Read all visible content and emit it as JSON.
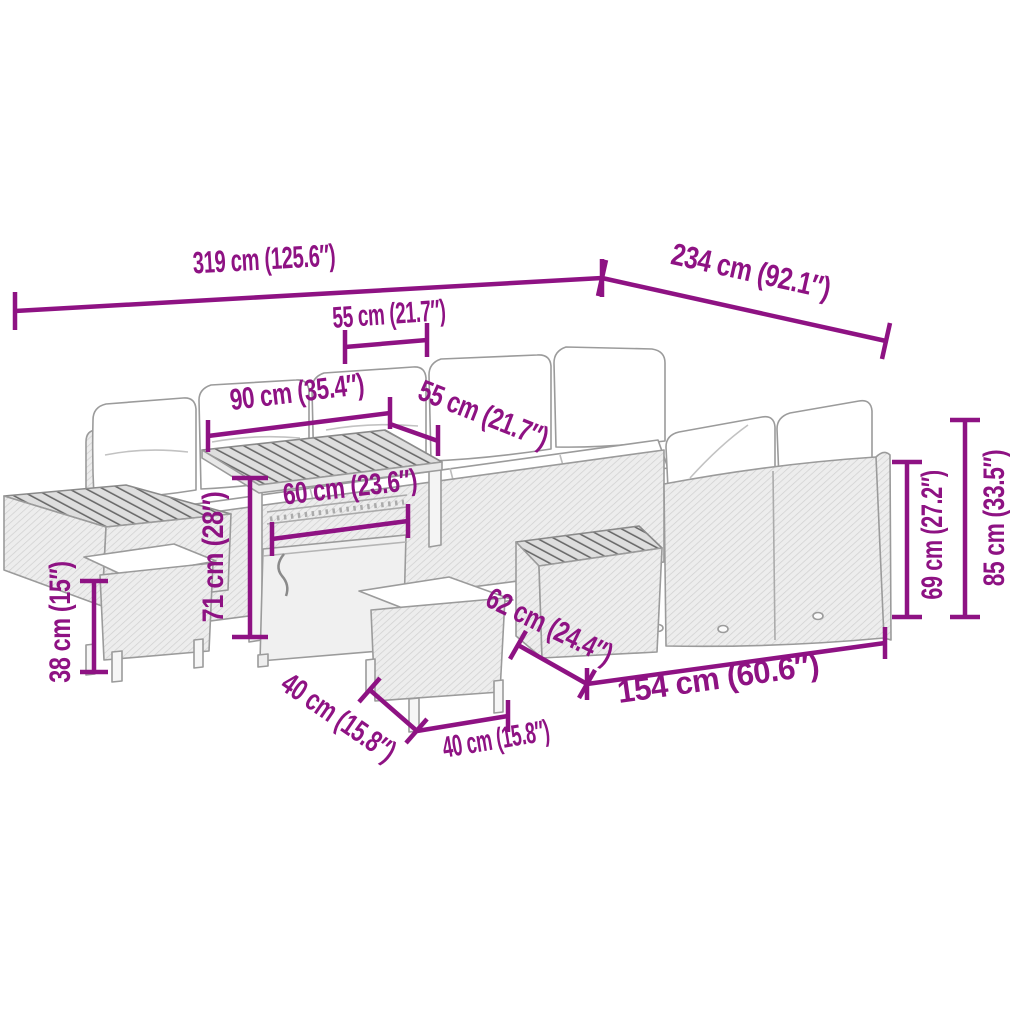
{
  "diagram": {
    "type": "product-dimension-diagram",
    "subject": "poly rattan garden corner sofa set with storage table, side tables and two cushion stools (line-art sketch)",
    "unit_format": "cm (inches)",
    "colors": {
      "accent": "#8E1283",
      "sketch": "#9b9b9b"
    },
    "dimensions": [
      {
        "id": "total-width",
        "label": "319 cm (125.6″)",
        "value_cm": 319,
        "value_in": 125.6
      },
      {
        "id": "total-depth",
        "label": "234 cm (92.1″)",
        "value_cm": 234,
        "value_in": 92.1
      },
      {
        "id": "seat-section-width",
        "label": "55 cm (21.7″)",
        "value_cm": 55,
        "value_in": 21.7
      },
      {
        "id": "table-length",
        "label": "90 cm (35.4″)",
        "value_cm": 90,
        "value_in": 35.4
      },
      {
        "id": "seat-depth",
        "label": "55 cm (21.7″)",
        "value_cm": 55,
        "value_in": 21.7
      },
      {
        "id": "table-width",
        "label": "60 cm (23.6″)",
        "value_cm": 60,
        "value_in": 23.6
      },
      {
        "id": "table-height",
        "label": "71 cm (28″)",
        "value_cm": 71,
        "value_in": 28
      },
      {
        "id": "stool-height",
        "label": "38 cm (15″)",
        "value_cm": 38,
        "value_in": 15
      },
      {
        "id": "stool-depth",
        "label": "40 cm (15.8″)",
        "value_cm": 40,
        "value_in": 15.8
      },
      {
        "id": "stool-width",
        "label": "40 cm (15.8″)",
        "value_cm": 40,
        "value_in": 15.8
      },
      {
        "id": "side-table-length",
        "label": "62 cm (24.4″)",
        "value_cm": 62,
        "value_in": 24.4
      },
      {
        "id": "front-section-length",
        "label": "154 cm (60.6″)",
        "value_cm": 154,
        "value_in": 60.6
      },
      {
        "id": "backrest-height",
        "label": "69 cm (27.2″)",
        "value_cm": 69,
        "value_in": 27.2
      },
      {
        "id": "total-height",
        "label": "85 cm (33.5″)",
        "value_cm": 85,
        "value_in": 33.5
      }
    ]
  }
}
